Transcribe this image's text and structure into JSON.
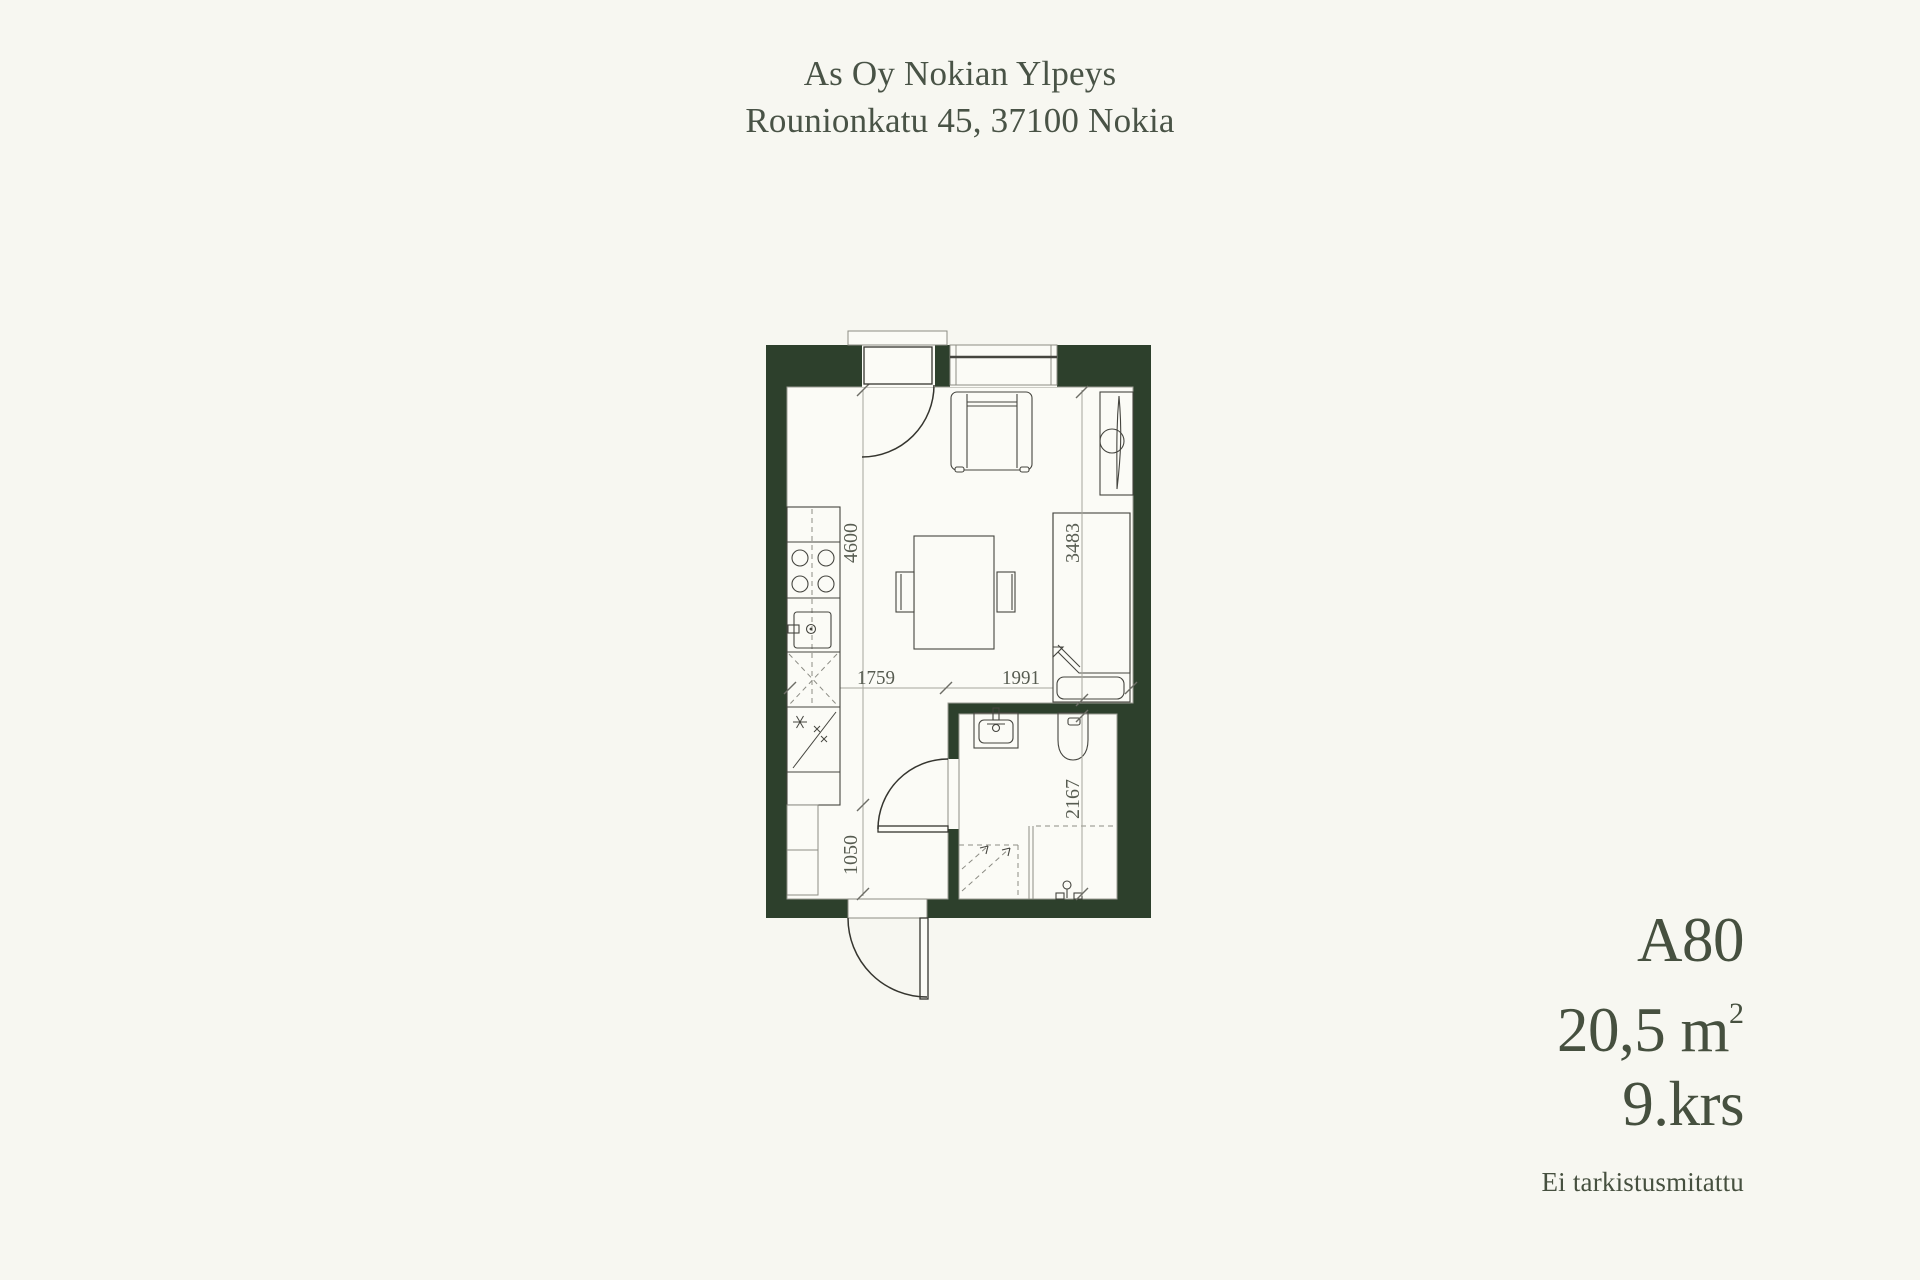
{
  "title": {
    "line1": "As Oy Nokian Ylpeys",
    "line2": "Rounionkatu 45, 37100 Nokia"
  },
  "unit": {
    "code": "A80",
    "area": "20,5 m",
    "area_sup": "2",
    "floor": "9.krs",
    "note": "Ei tarkistusmitattu"
  },
  "floorplan": {
    "dimensions": {
      "living_height_mm": "4600",
      "hall_height_mm": "1050",
      "kitchen_width_mm": "1759",
      "living_width_mm": "1991",
      "bed_wall_mm": "3483",
      "bathroom_depth_mm": "2167"
    },
    "colors": {
      "wall": "#2d402c",
      "background": "#f7f7f1",
      "floor": "#fbfbf6",
      "outline": "#45453f",
      "dimension_line": "#a6a69c",
      "text": "#475143"
    }
  }
}
